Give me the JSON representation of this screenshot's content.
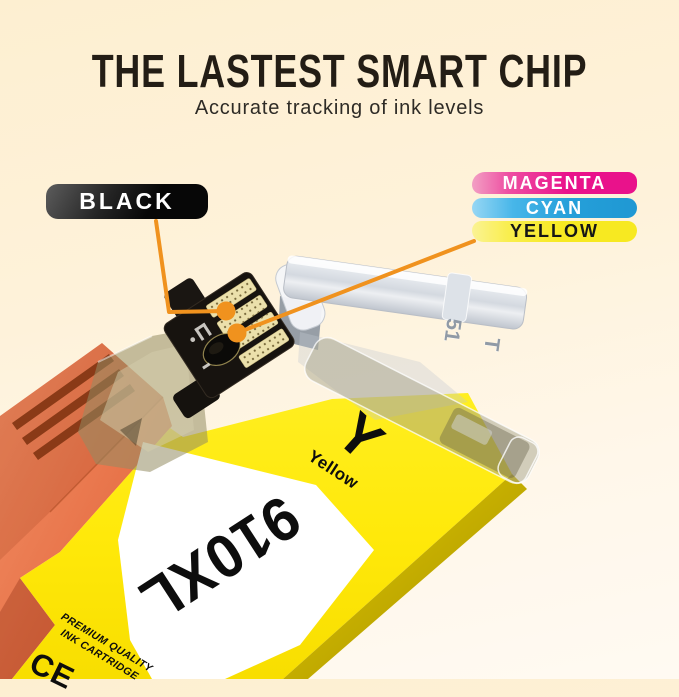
{
  "title": "THE LASTEST SMART CHIP",
  "subtitle": "Accurate tracking of ink levels",
  "callouts": {
    "black": {
      "label": "BLACK",
      "bg": "#0a0a0a",
      "text_color": "#ffffff"
    },
    "magenta": {
      "label": "MAGENTA",
      "bg": "#e9128b",
      "text_color": "#ffffff"
    },
    "cyan": {
      "label": "CYAN",
      "bg": "#259fd9",
      "text_color": "#ffffff"
    },
    "yellow": {
      "label": "YELLOW",
      "bg": "#f7e921",
      "text_color": "#1a1a1a"
    },
    "leader_color": "#f0921e"
  },
  "cartridge": {
    "model": "910XL",
    "color_letter": "Y",
    "color_name": "Yellow",
    "quality_line1": "PREMIUM QUALITY",
    "quality_line2": "INK CARTRIDGE",
    "certification_mark": "CE",
    "clip_markings": {
      "number": "51",
      "letter": "T"
    },
    "body_color": "#ffe90a",
    "carriage_color": "#e8744a",
    "chip_color": "#17130f"
  }
}
